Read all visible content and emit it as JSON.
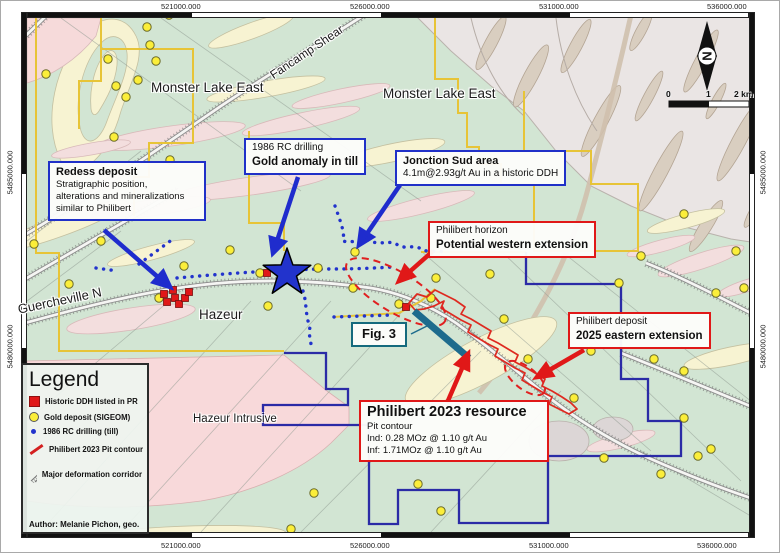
{
  "frame": {
    "top_labels": [
      "521000.000",
      "526000.000",
      "531000.000",
      "536000.000"
    ],
    "bottom_labels": [
      "521000.000",
      "526000.000",
      "531000.000",
      "536000.000"
    ],
    "left_labels": [
      "5485000.000",
      "5480000.000"
    ],
    "right_labels": [
      "5485000.000",
      "5480000.000"
    ]
  },
  "map_labels": {
    "monster_lake_east_west": "Monster Lake East",
    "monster_lake_east_east": "Monster Lake East",
    "fancamp_shear": "Fancamp Shear",
    "guercheville": "Guercheville N",
    "hazeur": "Hazeur",
    "hazeur_intrusive": "Hazeur Intrusive"
  },
  "callouts": {
    "redess": {
      "title": "Redess deposit",
      "lines": [
        "Stratigraphic position,",
        "alterations and mineralizations",
        "similar to Philibert"
      ]
    },
    "rc_1986": {
      "line1": "1986 RC drilling",
      "line2": "Gold anomaly in till"
    },
    "jonction_sud": {
      "title": "Jonction Sud area",
      "line": "4.1m@2.93g/t Au in a historic DDH"
    },
    "philibert_horizon": {
      "line1": "Philibert horizon",
      "line2": "Potential western extension"
    },
    "philibert_deposit": {
      "line1": "Philibert deposit",
      "line2": "2025 eastern extension"
    },
    "philibert_resource": {
      "title": "Philibert 2023 resource",
      "line1": "Pit contour",
      "line2": "Ind: 0.28 MOz @ 1.10 g/t Au",
      "line3": "Inf: 1.71MOz @ 1.10 g/t Au"
    },
    "fig3": {
      "label": "Fig. 3"
    }
  },
  "legend": {
    "title": "Legend",
    "items": [
      {
        "symbol": "red-square",
        "label": "Historic DDH listed in PR"
      },
      {
        "symbol": "yellow-circle",
        "label": "Gold deposit (SIGEOM)"
      },
      {
        "symbol": "blue-dot",
        "label": "1986 RC drilling (till)"
      },
      {
        "symbol": "red-line",
        "label": "Philibert 2023 Pit contour"
      },
      {
        "symbol": "hatched-band",
        "label": "Major deformation corridor"
      }
    ],
    "author": "Author: Melanie Pichon, geo."
  },
  "compass": {
    "label": "N"
  },
  "scale_bar": {
    "tick0": "0",
    "tick1": "1",
    "tick2": "2 km"
  },
  "colors": {
    "accent_blue": "#1f2ccd",
    "accent_red": "#e01818",
    "claim_yellow": "#e7c437",
    "claim_blue": "#2b2ba6",
    "teal": "#1d6b8d",
    "gold_dot": "#fbee3a",
    "background_green": "#d2e5d3"
  }
}
